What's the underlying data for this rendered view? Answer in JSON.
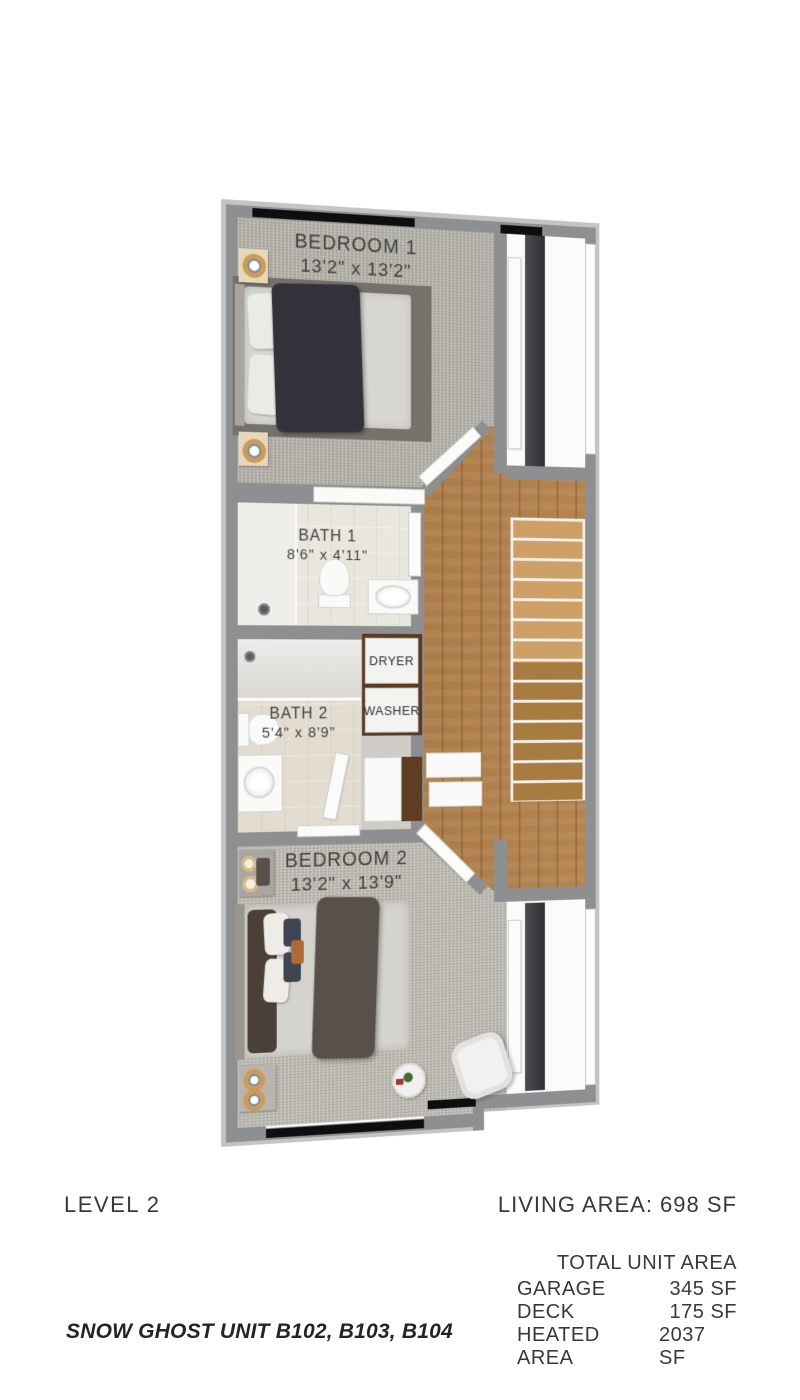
{
  "plan": {
    "rooms": [
      {
        "name": "BEDROOM 1",
        "dims": "13'2\" x 13'2\""
      },
      {
        "name": "BATH 1",
        "dims": "8'6\" x 4'11\""
      },
      {
        "name": "BATH 2",
        "dims": "5'4\" x 8'9\""
      },
      {
        "name": "BEDROOM 2",
        "dims": "13'2\" x 13'9\""
      }
    ],
    "appliances": [
      {
        "label": "DRYER"
      },
      {
        "label": "WASHER"
      }
    ]
  },
  "footer": {
    "level_label": "LEVEL 2",
    "living_area_label": "LIVING AREA: 698 SF",
    "area_table": {
      "title": "TOTAL UNIT AREA",
      "rows": [
        {
          "label": "GARAGE",
          "value": "345 SF"
        },
        {
          "label": "DECK",
          "value": "175 SF"
        },
        {
          "label": "HEATED AREA",
          "value": "2037 SF"
        }
      ]
    },
    "unit_title": "SNOW GHOST UNIT B102, B103, B104"
  },
  "palette": {
    "wall": "#8e8f91",
    "slab_edge": "#c3c4c6",
    "carpet": "#b2b0a7",
    "wood_floor": "#b07c44",
    "window_glass": "#0e0e0e",
    "laundry_cabinet": "#593a23",
    "label_text": "#3f3f3f"
  }
}
